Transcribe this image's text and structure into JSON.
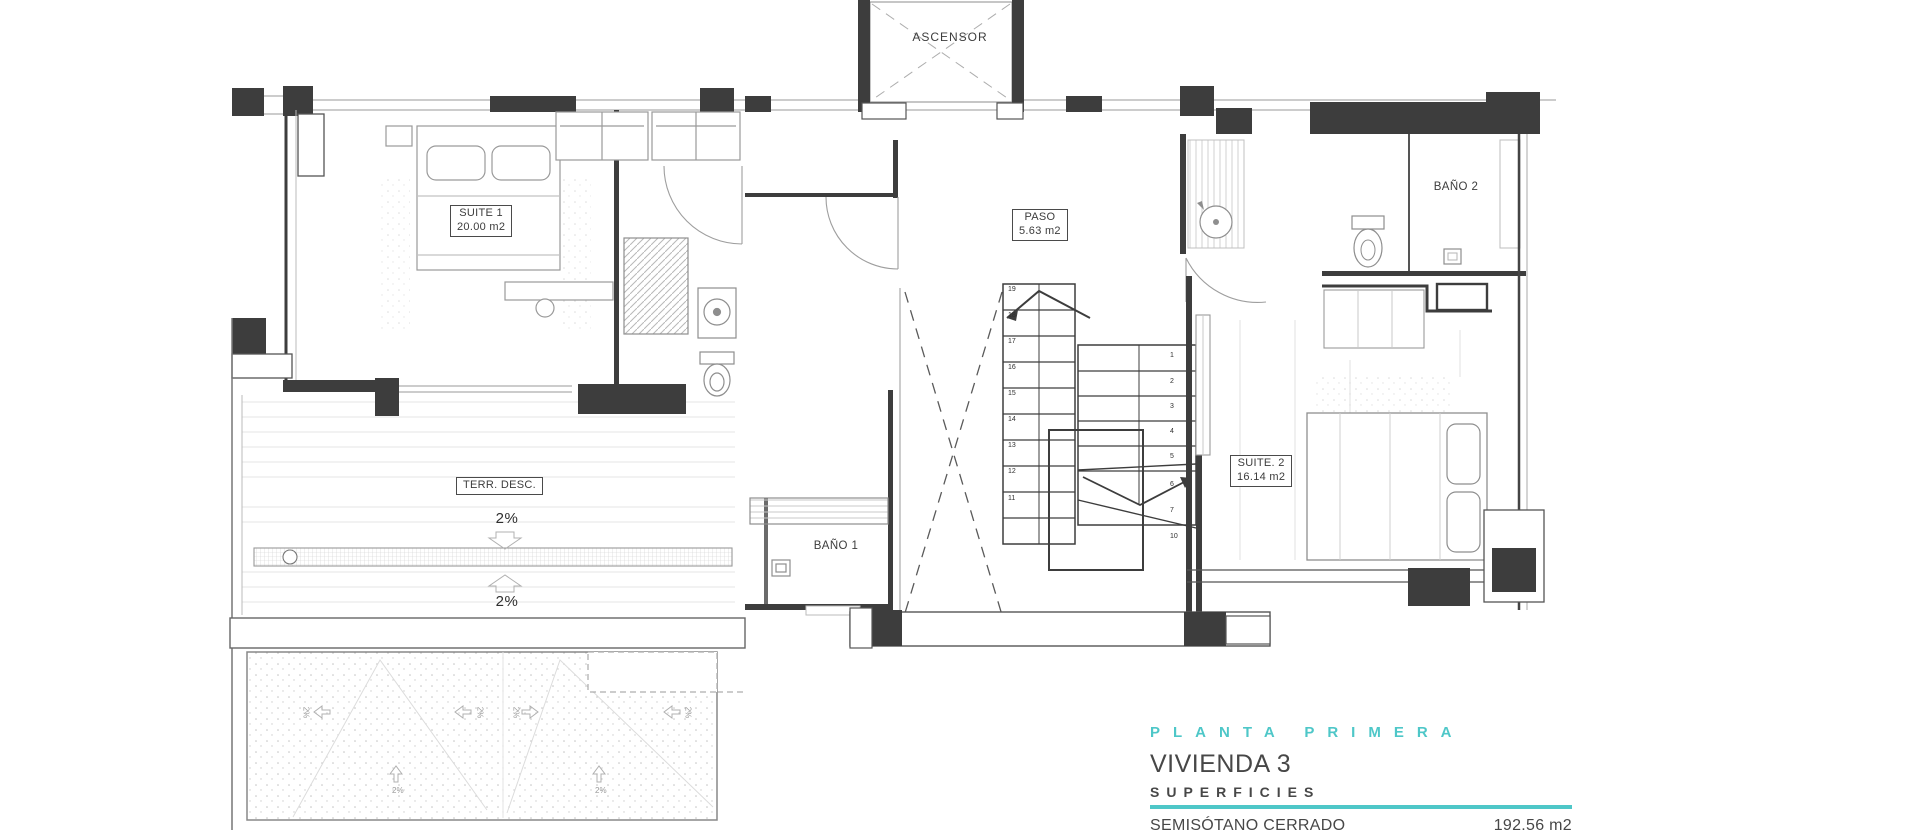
{
  "colors": {
    "accent": "#4ec7c8",
    "ink": "#3d3d3d"
  },
  "rooms": {
    "ascensor": {
      "name": "ASCENSOR"
    },
    "suite1": {
      "name": "SUITE 1",
      "area": "20.00 m2"
    },
    "paso": {
      "name": "PASO",
      "area": "5.63 m2"
    },
    "bano2": {
      "name": "BAÑO 2"
    },
    "suite2": {
      "name": "SUITE. 2",
      "area": "16.14 m2"
    },
    "terraza": {
      "name": "TERR. DESC."
    },
    "bano1": {
      "name": "BAÑO 1"
    }
  },
  "slopes": {
    "terrace_down": "2%",
    "terrace_up": "2%",
    "patio": "2%"
  },
  "stairs": {
    "upper": [
      "19",
      "18",
      "17",
      "16",
      "15",
      "14",
      "13",
      "12",
      "11"
    ],
    "lower": [
      "1",
      "2",
      "3",
      "4",
      "5",
      "6",
      "7"
    ],
    "lower_last": "10"
  },
  "title_block": {
    "floor": "PLANTA PRIMERA",
    "dwelling": "VIVIENDA 3",
    "section": "SUPERFICIES",
    "rows": [
      {
        "label": "SEMISÓTANO CERRADO",
        "value": "192.56 m2"
      },
      {
        "label": "PATIO INGLÉS",
        "value": "33.73 m2"
      }
    ]
  }
}
